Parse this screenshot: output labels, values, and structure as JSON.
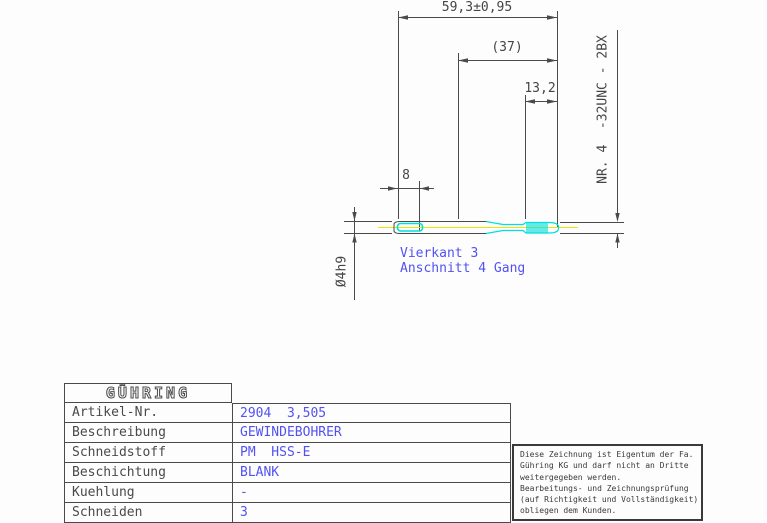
{
  "drawing": {
    "dim_overall_length": "59,3±0,95",
    "dim_thread_length": "(37)",
    "dim_chamfer_length": "13,2",
    "dim_square_length": "8",
    "dim_shank_diameter": "Ø4h9",
    "thread_designation": "NR. 4  -32UNC - 2BX",
    "label_square": "Vierkant 3",
    "label_lead": "Anschnitt 4 Gang"
  },
  "title_block": {
    "logo": "GÜHRING",
    "rows": [
      {
        "label": "Artikel-Nr.",
        "value": "2904  3,505"
      },
      {
        "label": "Beschreibung",
        "value": "GEWINDEBOHRER"
      },
      {
        "label": "Schneidstoff",
        "value": "PM  HSS-E"
      },
      {
        "label": "Beschichtung",
        "value": "BLANK"
      },
      {
        "label": "Kuehlung",
        "value": "-"
      },
      {
        "label": "Schneiden",
        "value": "3"
      }
    ]
  },
  "notice": {
    "lines": [
      "Diese Zeichnung ist Eigentum der Fa.",
      "Gühring KG und darf nicht an Dritte",
      "weitergegeben werden.",
      "Bearbeitungs- und Zeichnungsprüfung",
      "(auf Richtigkeit und Vollständigkeit)",
      "obliegen dem Kunden."
    ]
  },
  "colors": {
    "line_gray": "#4a4a4a",
    "text_blue": "#5252f2",
    "tool_cyan": "#00dede",
    "centerline_yellow": "#e9e900"
  }
}
